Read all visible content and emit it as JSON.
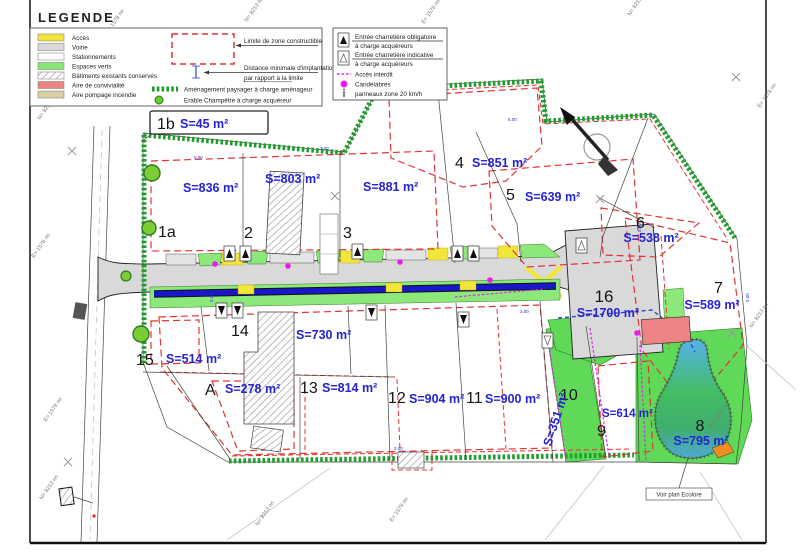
{
  "legend": {
    "title": "LEGENDE",
    "areas": [
      {
        "label": "Accès",
        "color": "#f2e53c"
      },
      {
        "label": "Voirie",
        "color": "#d9d9d9"
      },
      {
        "label": "Stationnements",
        "color": "#ffffff"
      },
      {
        "label": "Espaces verts",
        "color": "#86e873"
      },
      {
        "label": "Bâtiments existants conservés",
        "color": "hatch"
      },
      {
        "label": "Aire de convivialité",
        "color": "#ee8383"
      },
      {
        "label": "Aire pompage incendie",
        "color": "#d8cfa2"
      }
    ],
    "limite": "Limite de  zone constructible",
    "distance_1": "Distance minimale d'implantation",
    "distance_2": "par rapport à la limite",
    "amenagement": "Aménagement paysager à charge aménageur",
    "erable": "Erable Champêtre à charge acquéreur",
    "entree_obligatoire": "Entrée charretière  obligatoire",
    "entree_indicative": "Entrée charretière  indicative",
    "a_charge": "à charge acquéreurs",
    "acces_interdit": "Accès interdit",
    "candelabres": "Candélabres",
    "panneaux": "panneaux zone 20 km/h"
  },
  "lots": [
    {
      "num": "1b",
      "area": "S=45 m²"
    },
    {
      "num": "1a",
      "area": "S=836 m²"
    },
    {
      "num": "2",
      "area": "S=803 m²"
    },
    {
      "num": "3",
      "area": "S=881 m²"
    },
    {
      "num": "4",
      "area": "S=851 m²"
    },
    {
      "num": "5",
      "area": "S=639 m²"
    },
    {
      "num": "6",
      "area": "S=538 m²"
    },
    {
      "num": "7",
      "area": "S=589 m²"
    },
    {
      "num": "8",
      "area": "S=795 m²"
    },
    {
      "num": "9",
      "area": "S=614 m²"
    },
    {
      "num": "10",
      "area": "S=351 m²"
    },
    {
      "num": "11",
      "area": "S=900 m²"
    },
    {
      "num": "12",
      "area": "S=904 m²"
    },
    {
      "num": "13",
      "area": "S=814 m²"
    },
    {
      "num": "14",
      "area": "S=730 m²"
    },
    {
      "num": "15",
      "area": "S=514 m²"
    },
    {
      "num": "A",
      "area": "S=278 m²"
    },
    {
      "num": "16",
      "area": "S=1700 m²"
    }
  ],
  "annotations": {
    "see_plan": "Voir plan Ecolore"
  },
  "grid_labels": {
    "e": "E= 1578 nn",
    "n": "N= 8213 nn"
  },
  "dims": {
    "d1": "5.00",
    "d2": "3.00"
  },
  "colors": {
    "acces": "#f2e53c",
    "voirie": "#d9d9d9",
    "espaces_verts": "#86e873",
    "convivialite": "#ee8383",
    "pompage": "#d8cfa2",
    "limite_zone": "#e23333",
    "noue": "#1818c8",
    "acces_interdit": "#e81ee8",
    "amenagement": "#1e9e2a"
  }
}
